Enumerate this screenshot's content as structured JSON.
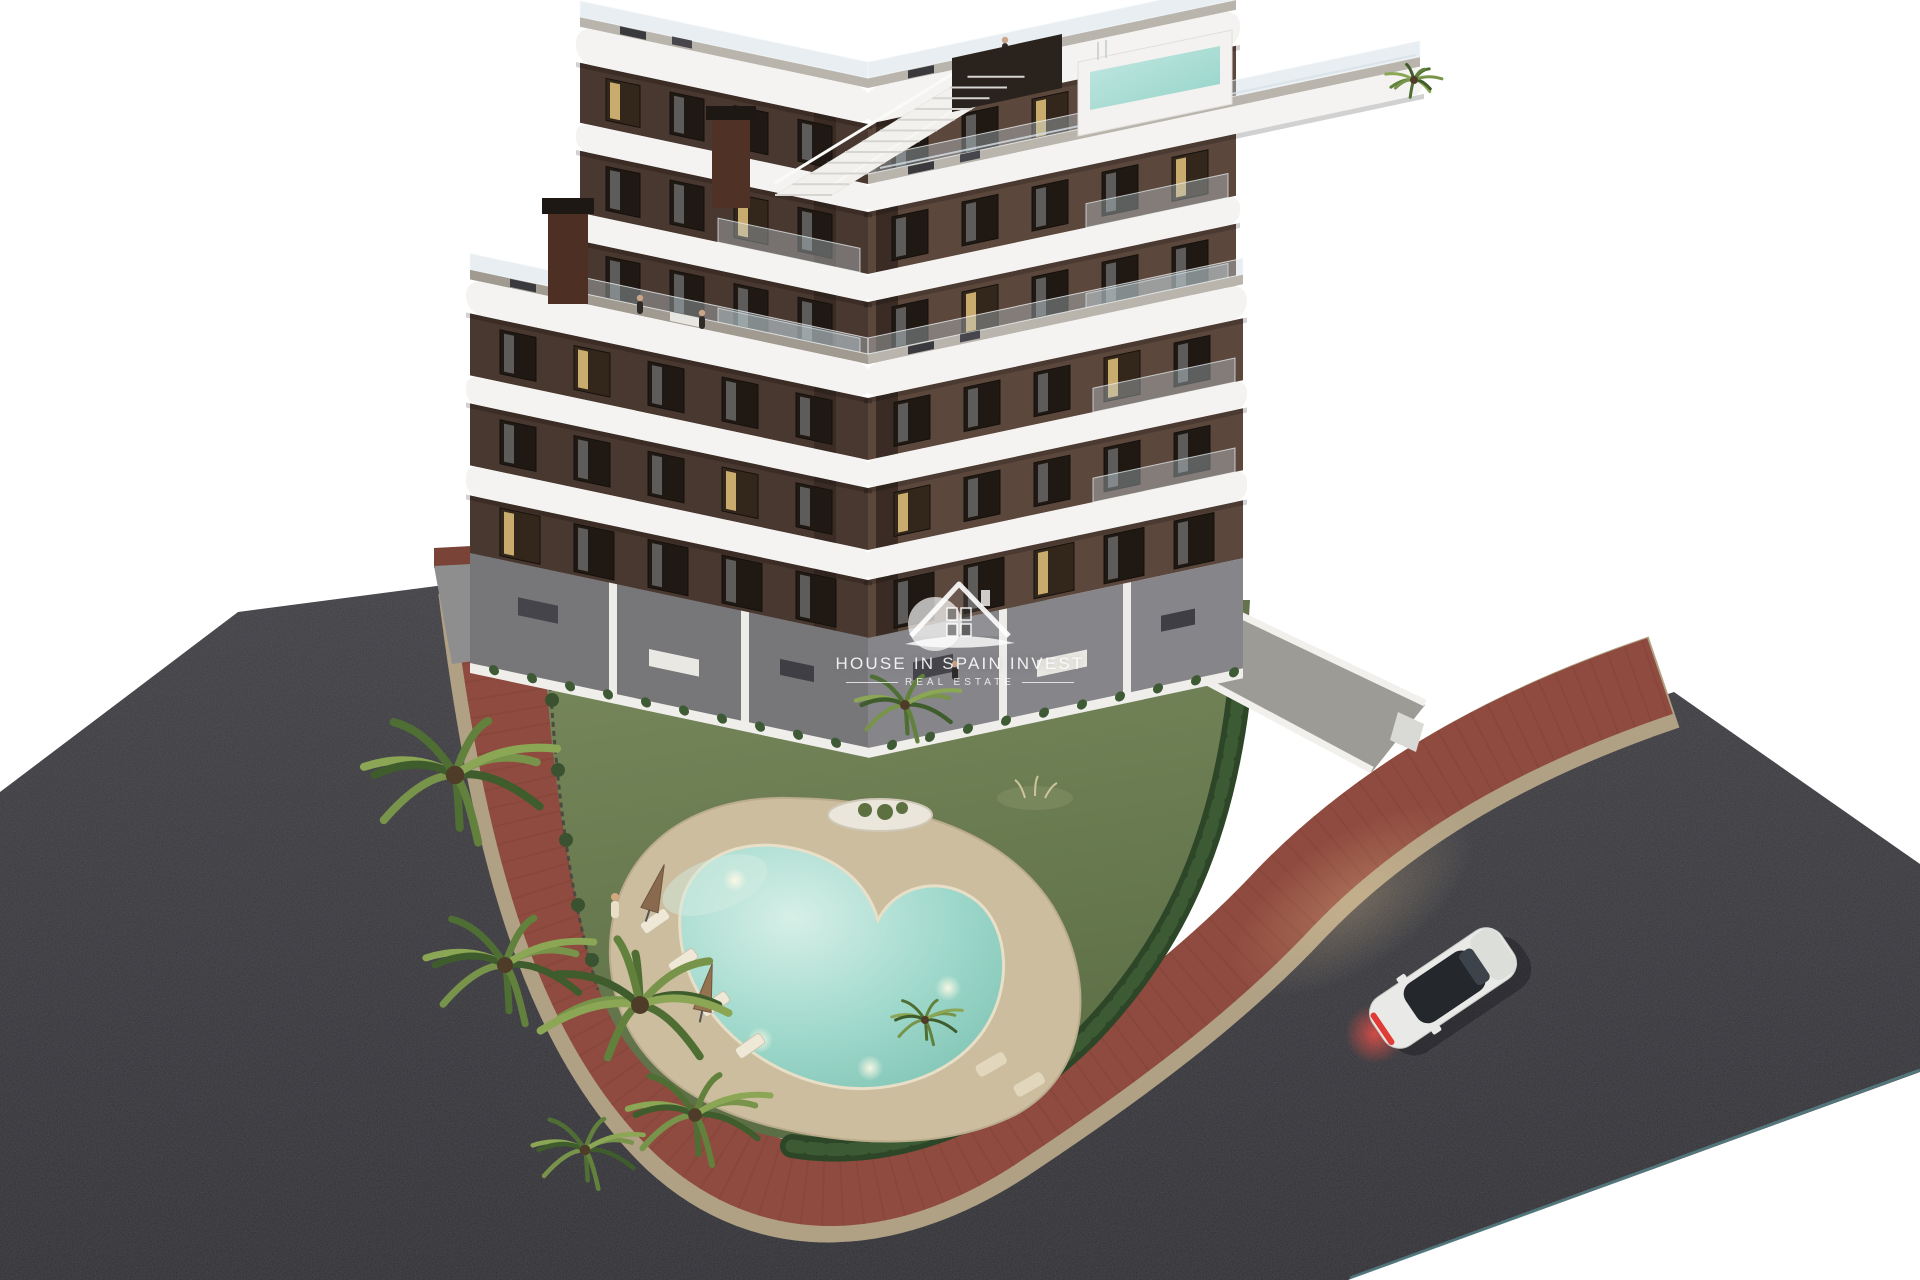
{
  "watermark": {
    "title": "HOUSE IN SPAIN INVEST",
    "subtitle": "REAL ESTATE"
  },
  "scene": {
    "description": "Aerial dusk 3D rendering of a modern 7-storey apartment residence with curved white balcony bands, rooftop terrace with plunge pool, landscaped garden with free-form swimming pool, palm trees, red paved sidewalks, asphalt streets and one white car",
    "building": {
      "floors": 7,
      "facade_left": "#49382f",
      "facade_right": "#5c473c",
      "accent": "#3a2c24",
      "band": "#f4f3f1",
      "deck": "#b9b5ad",
      "terrace_deck": "#a09a90",
      "window": "#201913",
      "window_lit": "#e4c37e",
      "curtain": "#9aa0a2",
      "glass_railing": "rgba(195,210,218,0.38)"
    },
    "rooftop": {
      "pool_water": "#a9ded6",
      "pergola": "#2a231d",
      "stairs": "#f2f1ee",
      "chimney": "#4e2f24"
    },
    "garden": {
      "lawn": "#6e7f53",
      "hedge": "#2e4628",
      "sand_deck": "#cbbd9d",
      "palm_count": 8,
      "umbrella": "#8a6a4e",
      "lounger": "#efe8d6"
    },
    "pool": {
      "water": "#9ed8cb",
      "coping": "#e8dfc8",
      "underwater_lights": 4
    },
    "roads": {
      "asphalt": "#33333a",
      "sidewalk": "#8f4b3f",
      "curb": "#b0a185"
    },
    "terraces": {
      "paving": "#7c7c80",
      "privacy_wall": "#efeeea"
    },
    "car": {
      "body": "#e9eae7",
      "glass": "#24272b",
      "taillight": "#e03b35"
    }
  }
}
